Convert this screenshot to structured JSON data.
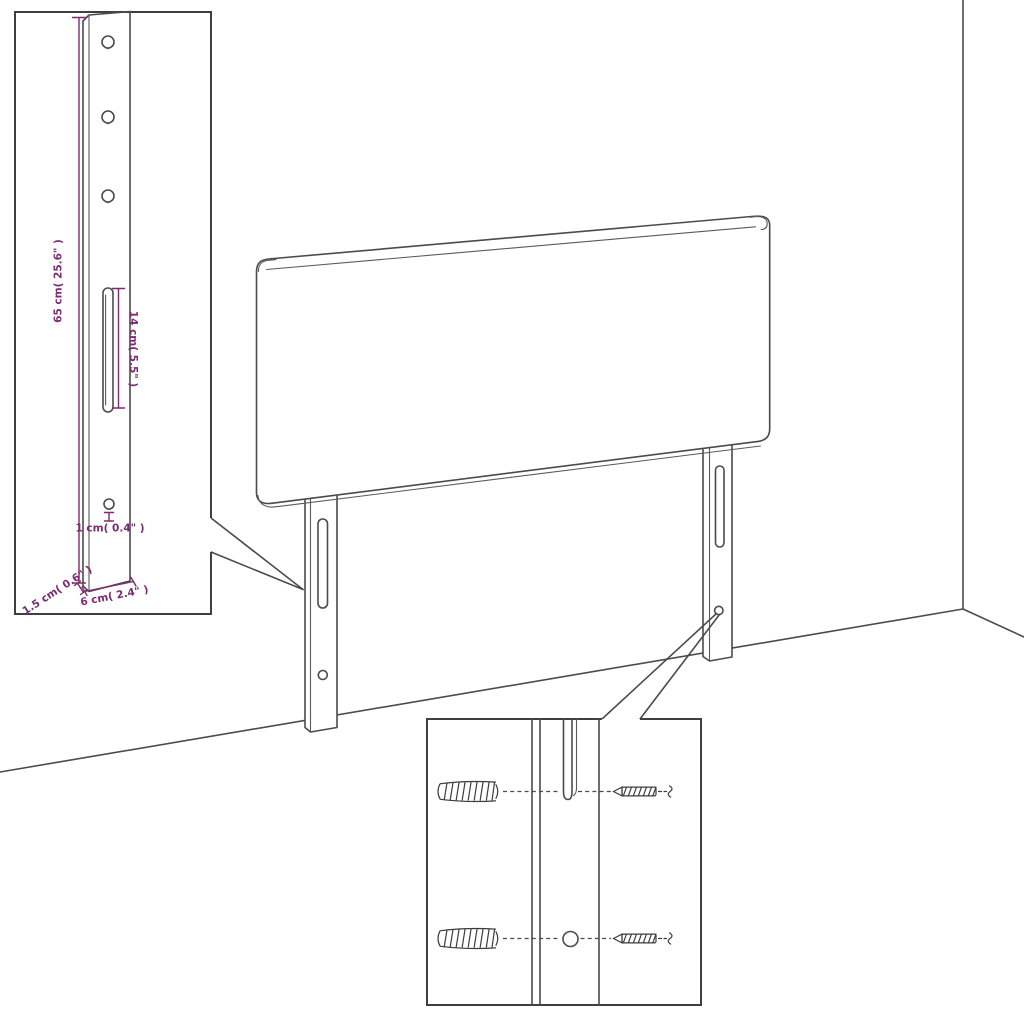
{
  "diagram": {
    "kind": "headboard-assembly-dimension-diagram",
    "background": "#ffffff",
    "colors": {
      "line": "#4b4b4b",
      "accent": "#7d2a71",
      "detail_box_border": "#3f3f3f"
    },
    "dims": {
      "leg_height": "65 cm( 25.6\" )",
      "slot_length": "14 cm( 5.5\" )",
      "hole_diameter": "1 cm( 0.4\" )",
      "leg_thickness": "1.5 cm( 0.6\" )",
      "leg_width": "6 cm( 2.4\" )"
    },
    "parts": {
      "panel": "headboard panel",
      "legs": "mounting legs with slot and hole",
      "hardware": "wall plugs and screws"
    }
  }
}
